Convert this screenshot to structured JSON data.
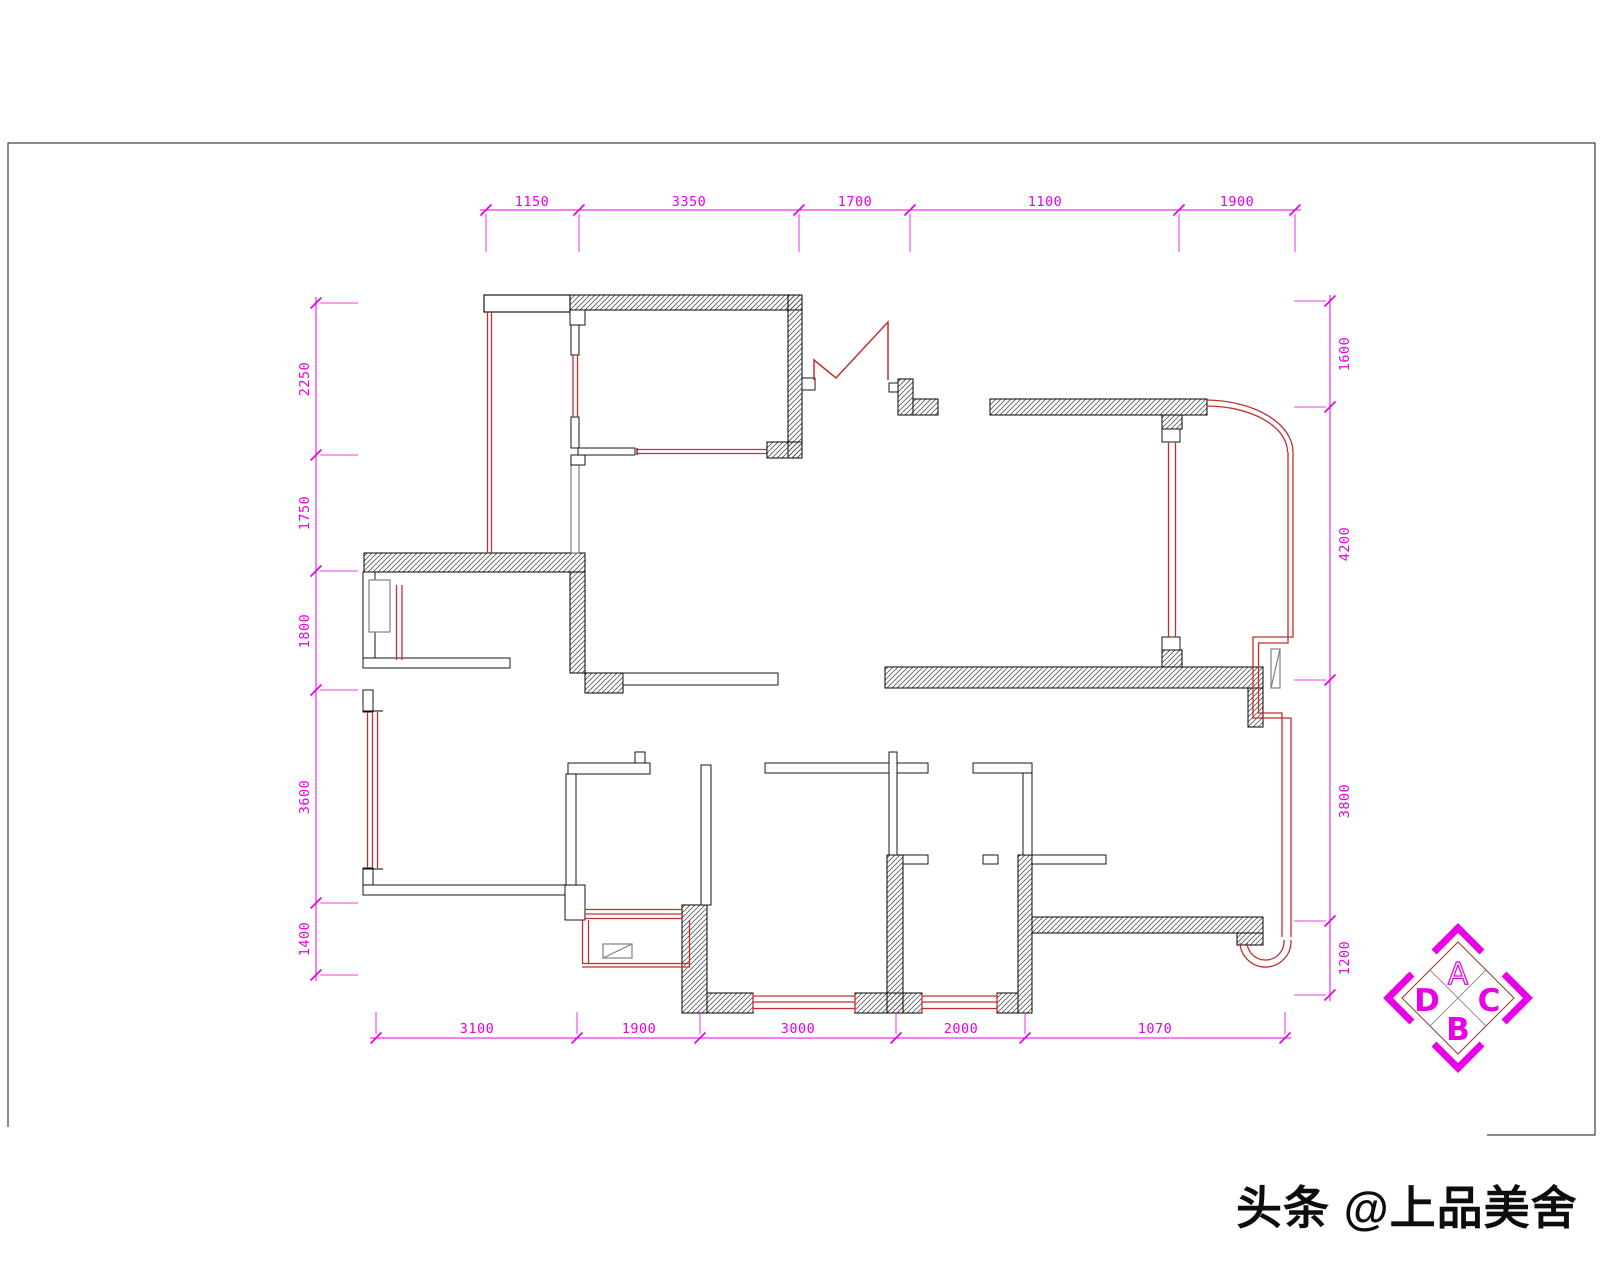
{
  "drawing": {
    "type": "residential floor plan (CAD)",
    "dimensions": {
      "top": [
        "1150",
        "3350",
        "1700",
        "1100",
        "1900"
      ],
      "left": [
        "2250",
        "1750",
        "1800",
        "3600",
        "1400"
      ],
      "right": [
        "1600",
        "4200",
        "3800",
        "1200"
      ],
      "bottom": [
        "3100",
        "1900",
        "3000",
        "2000",
        "1070"
      ]
    },
    "compass": {
      "top": "A",
      "right": "C",
      "bottom": "B",
      "left": "D"
    },
    "watermark": "头条 @上品美舍",
    "colors": {
      "dimension_magenta": "#e800e8",
      "wall_black": "#000000",
      "hatch_gray": "#3f3f3f",
      "window_red": "#c03030",
      "glass_gray": "#808080",
      "compass_magenta": "#e800e8",
      "compass_frame": "#993333"
    }
  }
}
